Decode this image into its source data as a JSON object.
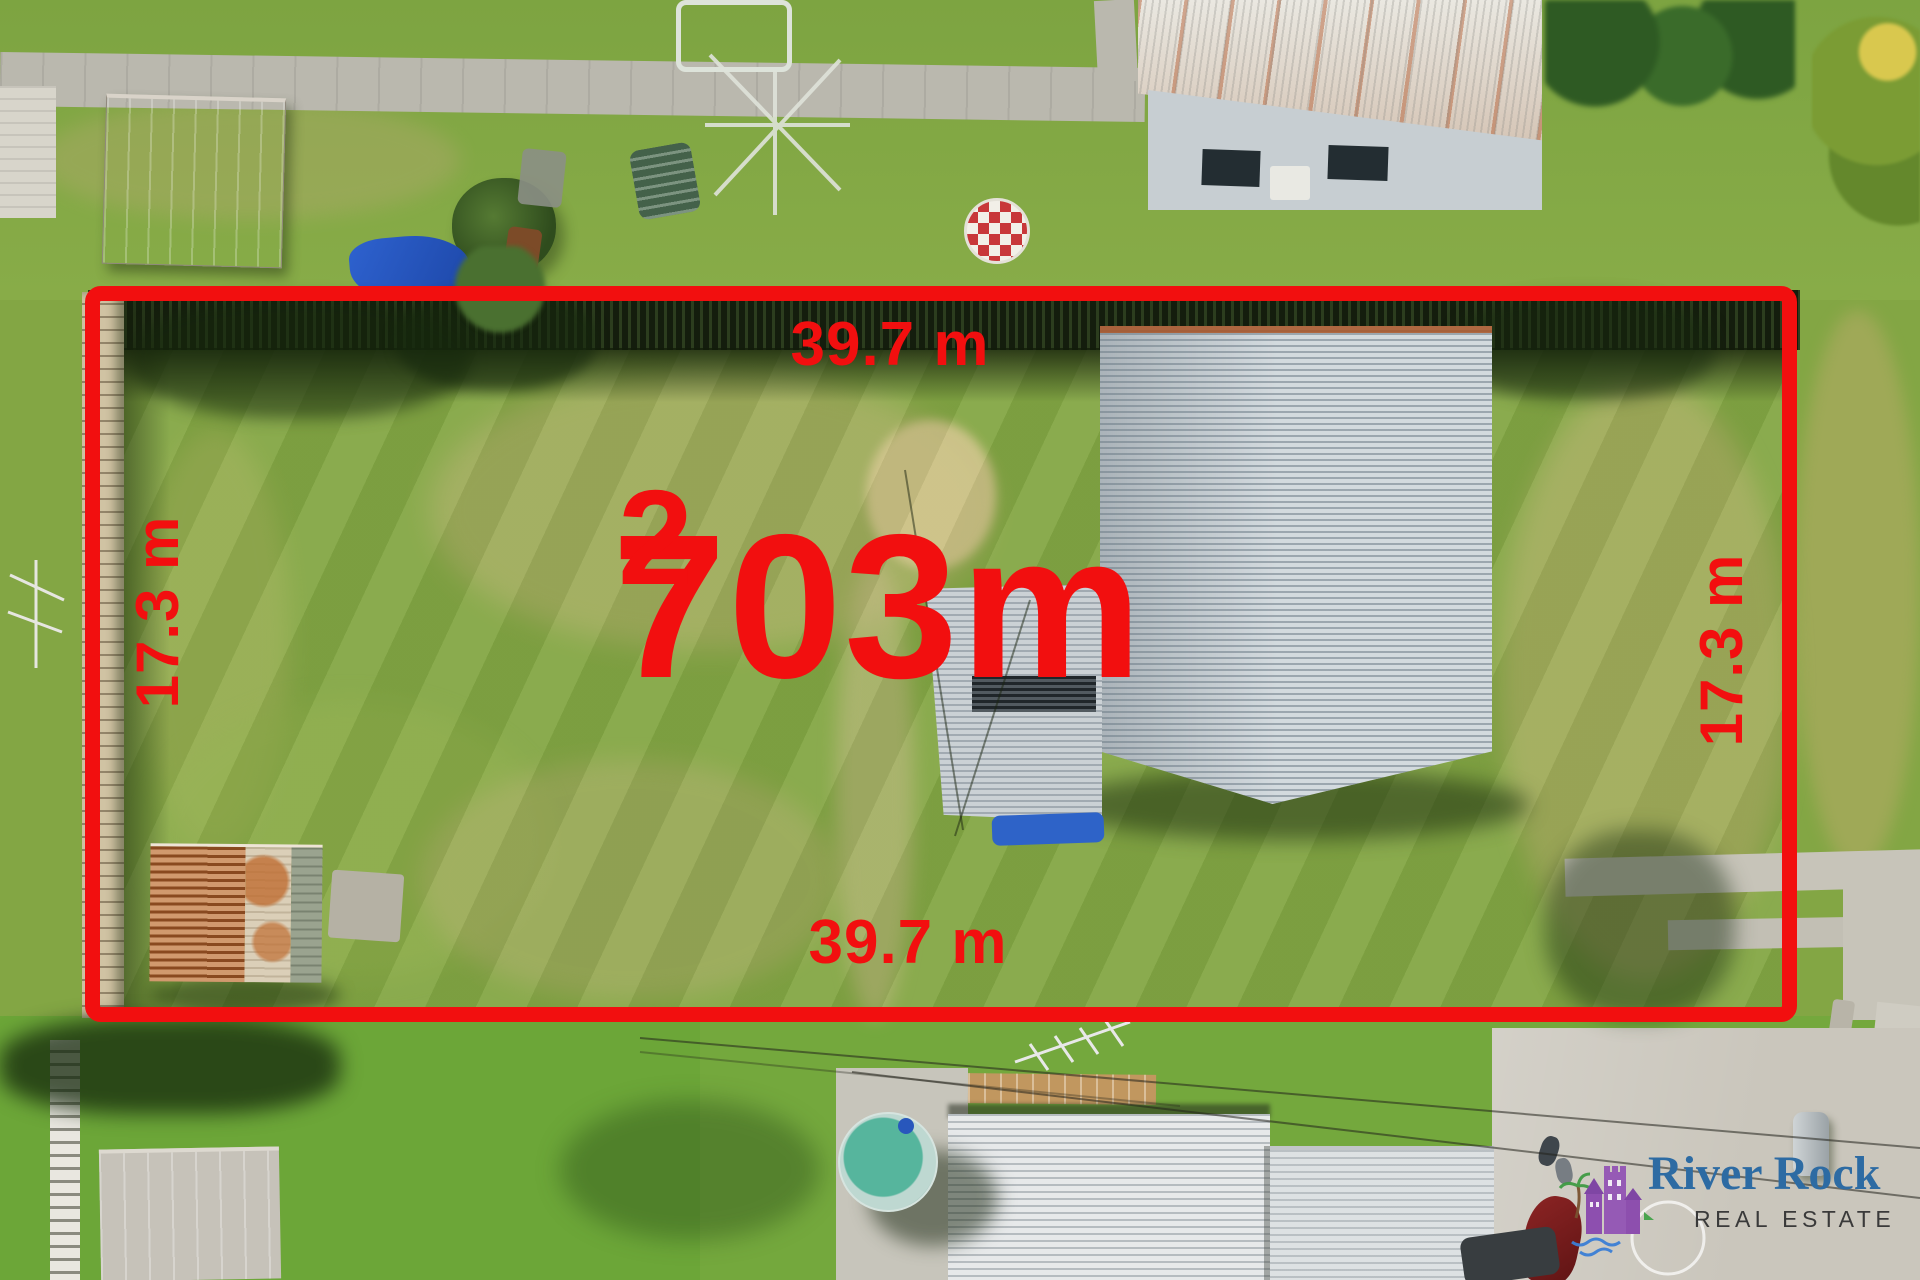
{
  "image_type": "aerial-property-listing-photo",
  "annotations": {
    "area_value": "703m",
    "area_superscript": "2",
    "width_top": "39.7 m",
    "width_bottom": "39.7 m",
    "depth_left": "17.3 m",
    "depth_right": "17.3 m",
    "boundary_color": "#f20f0f",
    "label_color": "#f20f0f"
  },
  "branding": {
    "name": "River Rock",
    "tagline": "REAL ESTATE",
    "name_color": "#2d6ba3",
    "tagline_color": "#3a3a3a",
    "mark": "purple-house-palm-waves-logo"
  }
}
